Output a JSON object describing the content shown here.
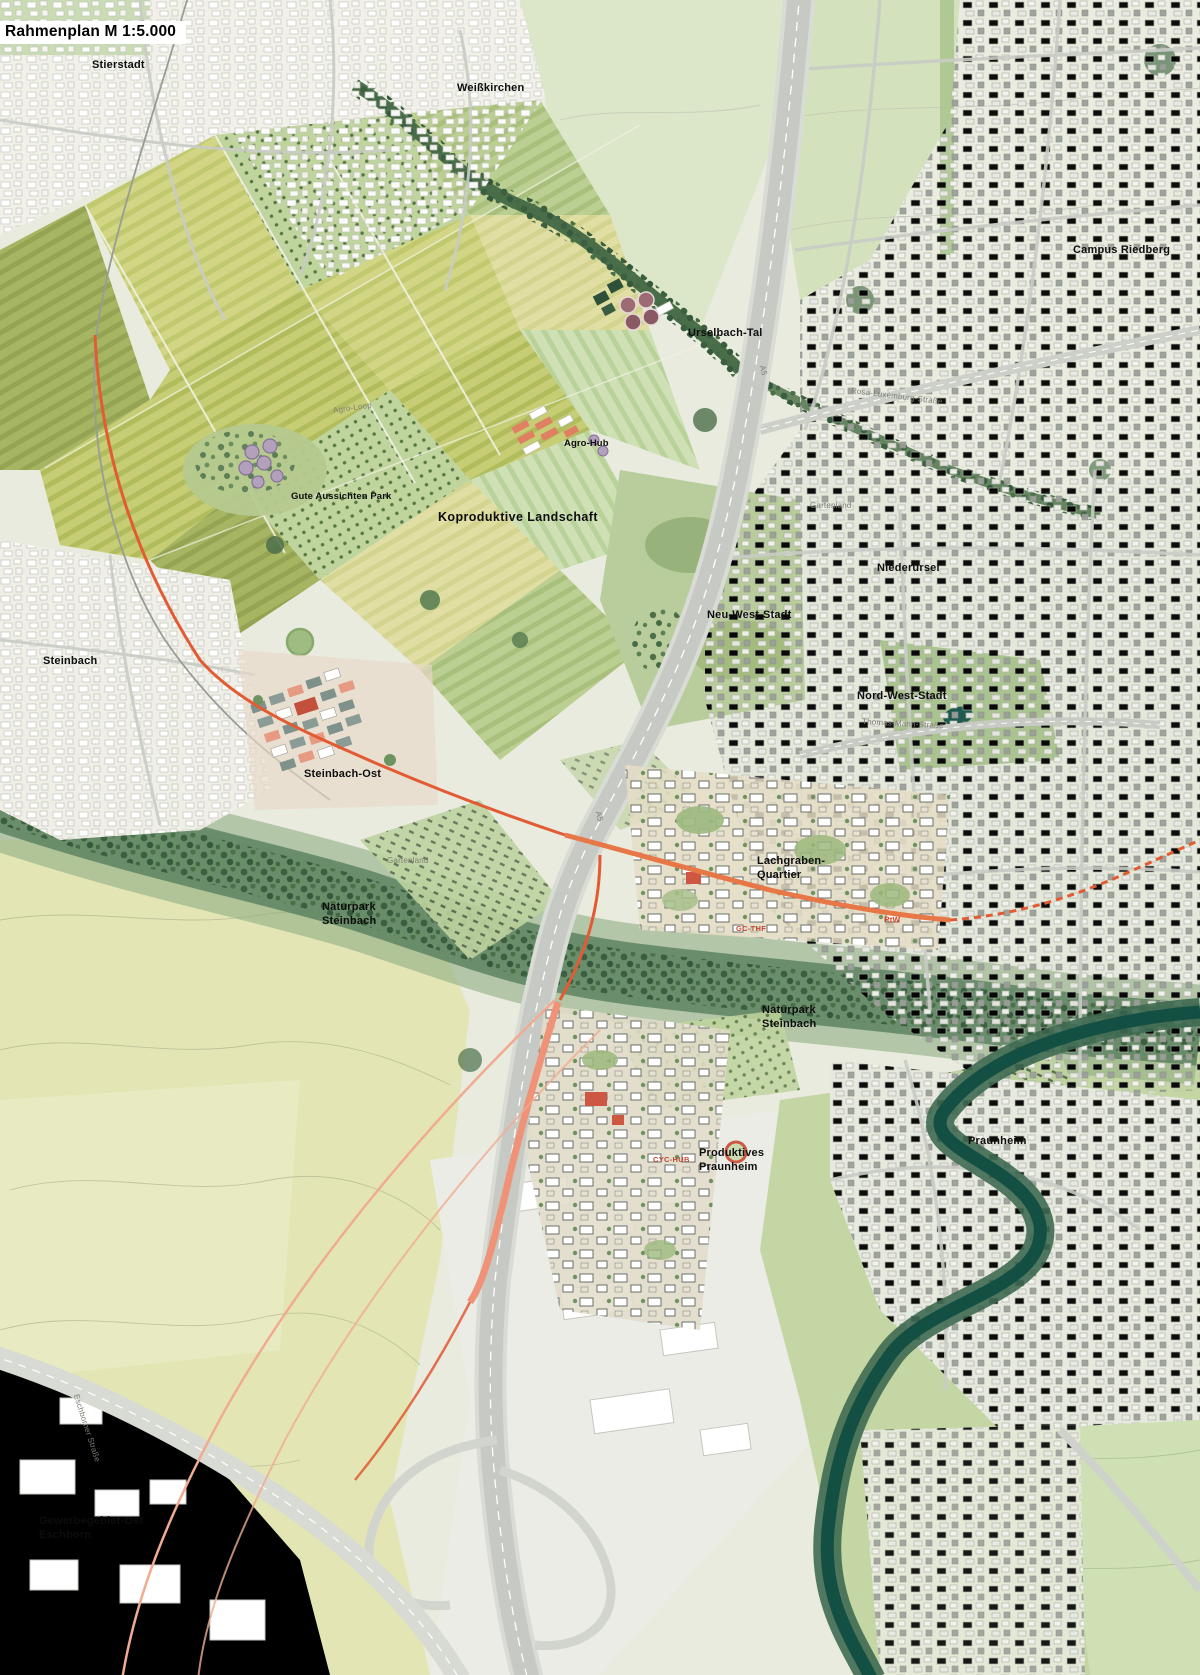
{
  "title": "Rahmenplan M 1:5.000",
  "map": {
    "type": "urban-framework-plan",
    "scale": "1:5.000"
  },
  "colors": {
    "route_accent": "#e25b33",
    "route_salmon": "#f0a98e",
    "water": "#134f43",
    "field_yellow": "#d2d584",
    "forest": "#4c6f4b",
    "new_quarter_red": "#cd5742",
    "highway_gray": "#c7cac4",
    "background": "#e9ebdf"
  },
  "labels": {
    "places": [
      {
        "id": "stierstadt",
        "text": "Stierstadt",
        "x": 92,
        "y": 58,
        "style": "md"
      },
      {
        "id": "weisskirchen",
        "text": "Weißkirchen",
        "x": 457,
        "y": 81,
        "style": "md"
      },
      {
        "id": "campus-riedberg",
        "text": "Campus Riedberg",
        "x": 1073,
        "y": 243,
        "style": "md"
      },
      {
        "id": "urselbach-tal",
        "text": "Urselbach-Tal",
        "x": 688,
        "y": 326,
        "style": "md"
      },
      {
        "id": "agro-hub",
        "text": "Agro-Hub",
        "x": 564,
        "y": 438,
        "style": "sm"
      },
      {
        "id": "gute-aussichten-park",
        "text": "Gute Aussichten Park",
        "x": 291,
        "y": 491,
        "style": "sm"
      },
      {
        "id": "koproduktive-landschaft",
        "text": "Koproduktive Landschaft",
        "x": 438,
        "y": 509,
        "style": "lg"
      },
      {
        "id": "niederursel",
        "text": "Niederursel",
        "x": 877,
        "y": 561,
        "style": "md"
      },
      {
        "id": "neu-west-stadt",
        "text": "Neu-West-Stadt",
        "x": 707,
        "y": 608,
        "style": "md"
      },
      {
        "id": "nord-west-stadt",
        "text": "Nord-West-Stadt",
        "x": 857,
        "y": 689,
        "style": "md"
      },
      {
        "id": "steinbach",
        "text": "Steinbach",
        "x": 43,
        "y": 654,
        "style": "md"
      },
      {
        "id": "steinbach-ost",
        "text": "Steinbach-Ost",
        "x": 304,
        "y": 767,
        "style": "md"
      },
      {
        "id": "lachgraben-quartier",
        "text": "Lachgraben-\nQuartier",
        "x": 757,
        "y": 854,
        "style": "md"
      },
      {
        "id": "naturpark-steinbach-west",
        "text": "Naturpark\nSteinbach",
        "x": 322,
        "y": 900,
        "style": "md"
      },
      {
        "id": "naturpark-steinbach-ost",
        "text": "Naturpark\nSteinbach",
        "x": 762,
        "y": 1003,
        "style": "md"
      },
      {
        "id": "produktives-praunheim",
        "text": "Produktives\nPraunheim",
        "x": 699,
        "y": 1146,
        "style": "md"
      },
      {
        "id": "praunheim",
        "text": "Praunheim",
        "x": 968,
        "y": 1134,
        "style": "md"
      },
      {
        "id": "gewerbegebiet-ost-eschborn",
        "text": "Gewerbegebiet-Ost\nEschborn",
        "x": 39,
        "y": 1514,
        "style": "md"
      }
    ],
    "streets": [
      {
        "id": "agro-loop",
        "text": "Agro-Loop",
        "x": 333,
        "y": 406,
        "rotate": -8
      },
      {
        "id": "rosa-luxemburg-strasse",
        "text": "Rosa-Luxemburg-Straße",
        "x": 851,
        "y": 386,
        "rotate": 7
      },
      {
        "id": "thomas-mann-strasse",
        "text": "Thomas-Mann-Straße",
        "x": 862,
        "y": 717,
        "rotate": 3
      },
      {
        "id": "eschborner-strasse",
        "text": "Eschborner Straße",
        "x": 76,
        "y": 1390,
        "rotate": 72
      },
      {
        "id": "gartenland-nord",
        "text": "Gartenland",
        "x": 810,
        "y": 501,
        "rotate": 0
      },
      {
        "id": "gartenland-sued",
        "text": "Gartenland",
        "x": 387,
        "y": 856,
        "rotate": 0
      },
      {
        "id": "a5-nord",
        "text": "A5",
        "x": 762,
        "y": 361,
        "rotate": 75
      },
      {
        "id": "a5-sued",
        "text": "A5",
        "x": 598,
        "y": 807,
        "rotate": 75
      }
    ],
    "route_markers": [
      {
        "id": "rtw",
        "text": "RtW",
        "x": 884,
        "y": 915,
        "rotate": 2
      }
    ],
    "site_codes": [
      {
        "id": "gc-thf",
        "text": "GC-THF",
        "x": 736,
        "y": 924,
        "rotate": 0
      },
      {
        "id": "cyc-hub",
        "text": "CYC-HUB",
        "x": 653,
        "y": 1155,
        "rotate": 0
      }
    ]
  }
}
